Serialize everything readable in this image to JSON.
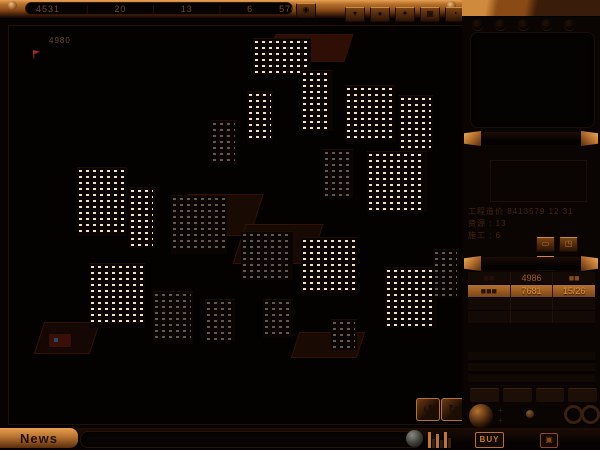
{
  "colors": {
    "copper": "#c07a33",
    "copper_bright": "#e09a50",
    "copper_dark": "#5a2c0e",
    "window_lit": "#efe3c4",
    "accent_text": "#e09038",
    "roof_red": "#2e0e05"
  },
  "top_bar": {
    "fields": [
      "4531",
      "20",
      "13",
      "6"
    ],
    "separator": "|",
    "right_value": "570630",
    "single_button_glyph": "◉",
    "buttons": [
      {
        "icon": "flag-icon",
        "glyph": "▾"
      },
      {
        "icon": "person-icon",
        "glyph": "●"
      },
      {
        "icon": "star-icon",
        "glyph": "✦"
      },
      {
        "icon": "grid-icon",
        "glyph": "▦"
      },
      {
        "icon": "clock-icon",
        "glyph": "◔"
      }
    ]
  },
  "viewport": {
    "overlay_label": "4980",
    "nav_buttons": [
      {
        "name": "rotate-left-button",
        "glyph": "↺"
      },
      {
        "name": "rotate-right-button",
        "glyph": "↻"
      }
    ],
    "city": {
      "buildings": [
        {
          "x": 244,
          "y": 13,
          "w": 58,
          "h": 36,
          "dim": false
        },
        {
          "x": 292,
          "y": 45,
          "w": 32,
          "h": 60,
          "dim": false
        },
        {
          "x": 336,
          "y": 60,
          "w": 50,
          "h": 56,
          "dim": false
        },
        {
          "x": 390,
          "y": 70,
          "w": 34,
          "h": 54,
          "dim": false
        },
        {
          "x": 238,
          "y": 66,
          "w": 26,
          "h": 50,
          "dim": false
        },
        {
          "x": 202,
          "y": 95,
          "w": 26,
          "h": 44,
          "dim": true
        },
        {
          "x": 314,
          "y": 124,
          "w": 30,
          "h": 48,
          "dim": true
        },
        {
          "x": 358,
          "y": 126,
          "w": 60,
          "h": 60,
          "dim": false
        },
        {
          "x": 68,
          "y": 142,
          "w": 50,
          "h": 68,
          "dim": false
        },
        {
          "x": 120,
          "y": 162,
          "w": 26,
          "h": 60,
          "dim": false
        },
        {
          "x": 162,
          "y": 170,
          "w": 56,
          "h": 58,
          "dim": true
        },
        {
          "x": 232,
          "y": 206,
          "w": 52,
          "h": 48,
          "dim": true
        },
        {
          "x": 292,
          "y": 212,
          "w": 56,
          "h": 58,
          "dim": false
        },
        {
          "x": 376,
          "y": 242,
          "w": 52,
          "h": 60,
          "dim": false
        },
        {
          "x": 424,
          "y": 224,
          "w": 26,
          "h": 48,
          "dim": true
        },
        {
          "x": 80,
          "y": 238,
          "w": 56,
          "h": 64,
          "dim": false
        },
        {
          "x": 144,
          "y": 266,
          "w": 40,
          "h": 52,
          "dim": true
        },
        {
          "x": 196,
          "y": 274,
          "w": 30,
          "h": 42,
          "dim": true
        },
        {
          "x": 254,
          "y": 274,
          "w": 30,
          "h": 38,
          "dim": true
        },
        {
          "x": 322,
          "y": 294,
          "w": 26,
          "h": 30,
          "dim": true
        }
      ],
      "roofs": [
        {
          "x": 262,
          "y": 8,
          "w": 76,
          "h": 26,
          "c": "#2e0e05"
        },
        {
          "x": 172,
          "y": 168,
          "w": 74,
          "h": 40,
          "c": "#190a04"
        },
        {
          "x": 230,
          "y": 198,
          "w": 76,
          "h": 38,
          "c": "#170904"
        },
        {
          "x": 286,
          "y": 306,
          "w": 64,
          "h": 24,
          "c": "#190a04"
        },
        {
          "x": 30,
          "y": 296,
          "w": 54,
          "h": 30,
          "c": "#150804"
        }
      ],
      "vehicle": {
        "x": 40,
        "y": 308
      }
    }
  },
  "right_panel": {
    "holes": 5,
    "info": {
      "rows": [
        "工程造价 8413579 12 31",
        "资源 :  13",
        "施工 :  6"
      ],
      "buttons": [
        {
          "icon": "window-icon",
          "glyph": "▭"
        },
        {
          "icon": "layout-icon",
          "glyph": "◳"
        },
        {
          "icon": "panel-icon",
          "glyph": "◱"
        }
      ]
    },
    "stats": {
      "rows": [
        {
          "c1": "■■",
          "c2": "4986",
          "c3": "■■",
          "hl": false
        },
        {
          "c1": "■■■",
          "c2": "7681",
          "c3": "15/26",
          "hl": true
        },
        {
          "c1": "",
          "c2": "",
          "c3": "",
          "hl": false
        },
        {
          "c1": "",
          "c2": "",
          "c3": "",
          "hl": false
        }
      ]
    },
    "slots": 4
  },
  "bottom_bar": {
    "news_label": "News",
    "buy_label": "BUY",
    "eject_glyph": "▣",
    "eq_bars": [
      {
        "h": 16,
        "c": "#c07830"
      },
      {
        "h": 9,
        "c": "#3a2010"
      },
      {
        "h": 14,
        "c": "#b5722e"
      },
      {
        "h": 8,
        "c": "#30180a"
      },
      {
        "h": 16,
        "c": "#c07830"
      },
      {
        "h": 10,
        "c": "#3a2010"
      }
    ]
  }
}
